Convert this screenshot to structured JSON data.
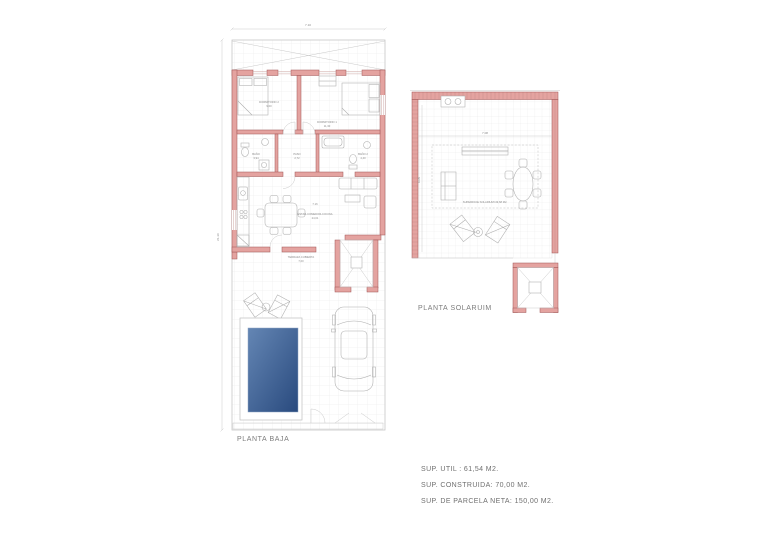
{
  "planta_baja": {
    "label": "PLANTA BAJA",
    "dim_width": "7.10",
    "dim_height": "21.10",
    "dim_interior": "7.16",
    "rooms": {
      "dormitorio2": {
        "label": "DORMITORIO 2",
        "area": "9,00"
      },
      "dormitorio1": {
        "label": "DORMITORIO 1",
        "area": "11,30"
      },
      "bano1": {
        "label": "BAÑO",
        "area": "3,94"
      },
      "paso": {
        "label": "PASO",
        "area": "2,72"
      },
      "bano2": {
        "label": "BAÑO 2",
        "area": "4,40"
      },
      "estar": {
        "label": "ESTAR-COMEDOR-COCINA",
        "area": "24,01"
      },
      "terraza": {
        "label": "TERRAZA CUBIERTA",
        "area": "7,00"
      }
    }
  },
  "planta_solarium": {
    "label": "PLANTA SOLARUIM",
    "dim_width": "7.08",
    "dim_height": "6.05",
    "surface": "SUPERFICIE SOLARIUM=49,68 M2."
  },
  "summary": {
    "sup_util": "SUP. UTIL : 61,54 M2.",
    "sup_construida": "SUP. CONSTRUIDA: 70,00 M2.",
    "sup_parcela": "SUP. DE PARCELA NETA: 150,00 M2."
  },
  "colors": {
    "wall_fill": "#e4a3a0",
    "wall_stroke": "#a05454",
    "pool_light": "#6486b4",
    "pool_dark": "#294a7e",
    "grid": "#e4e4e4"
  }
}
